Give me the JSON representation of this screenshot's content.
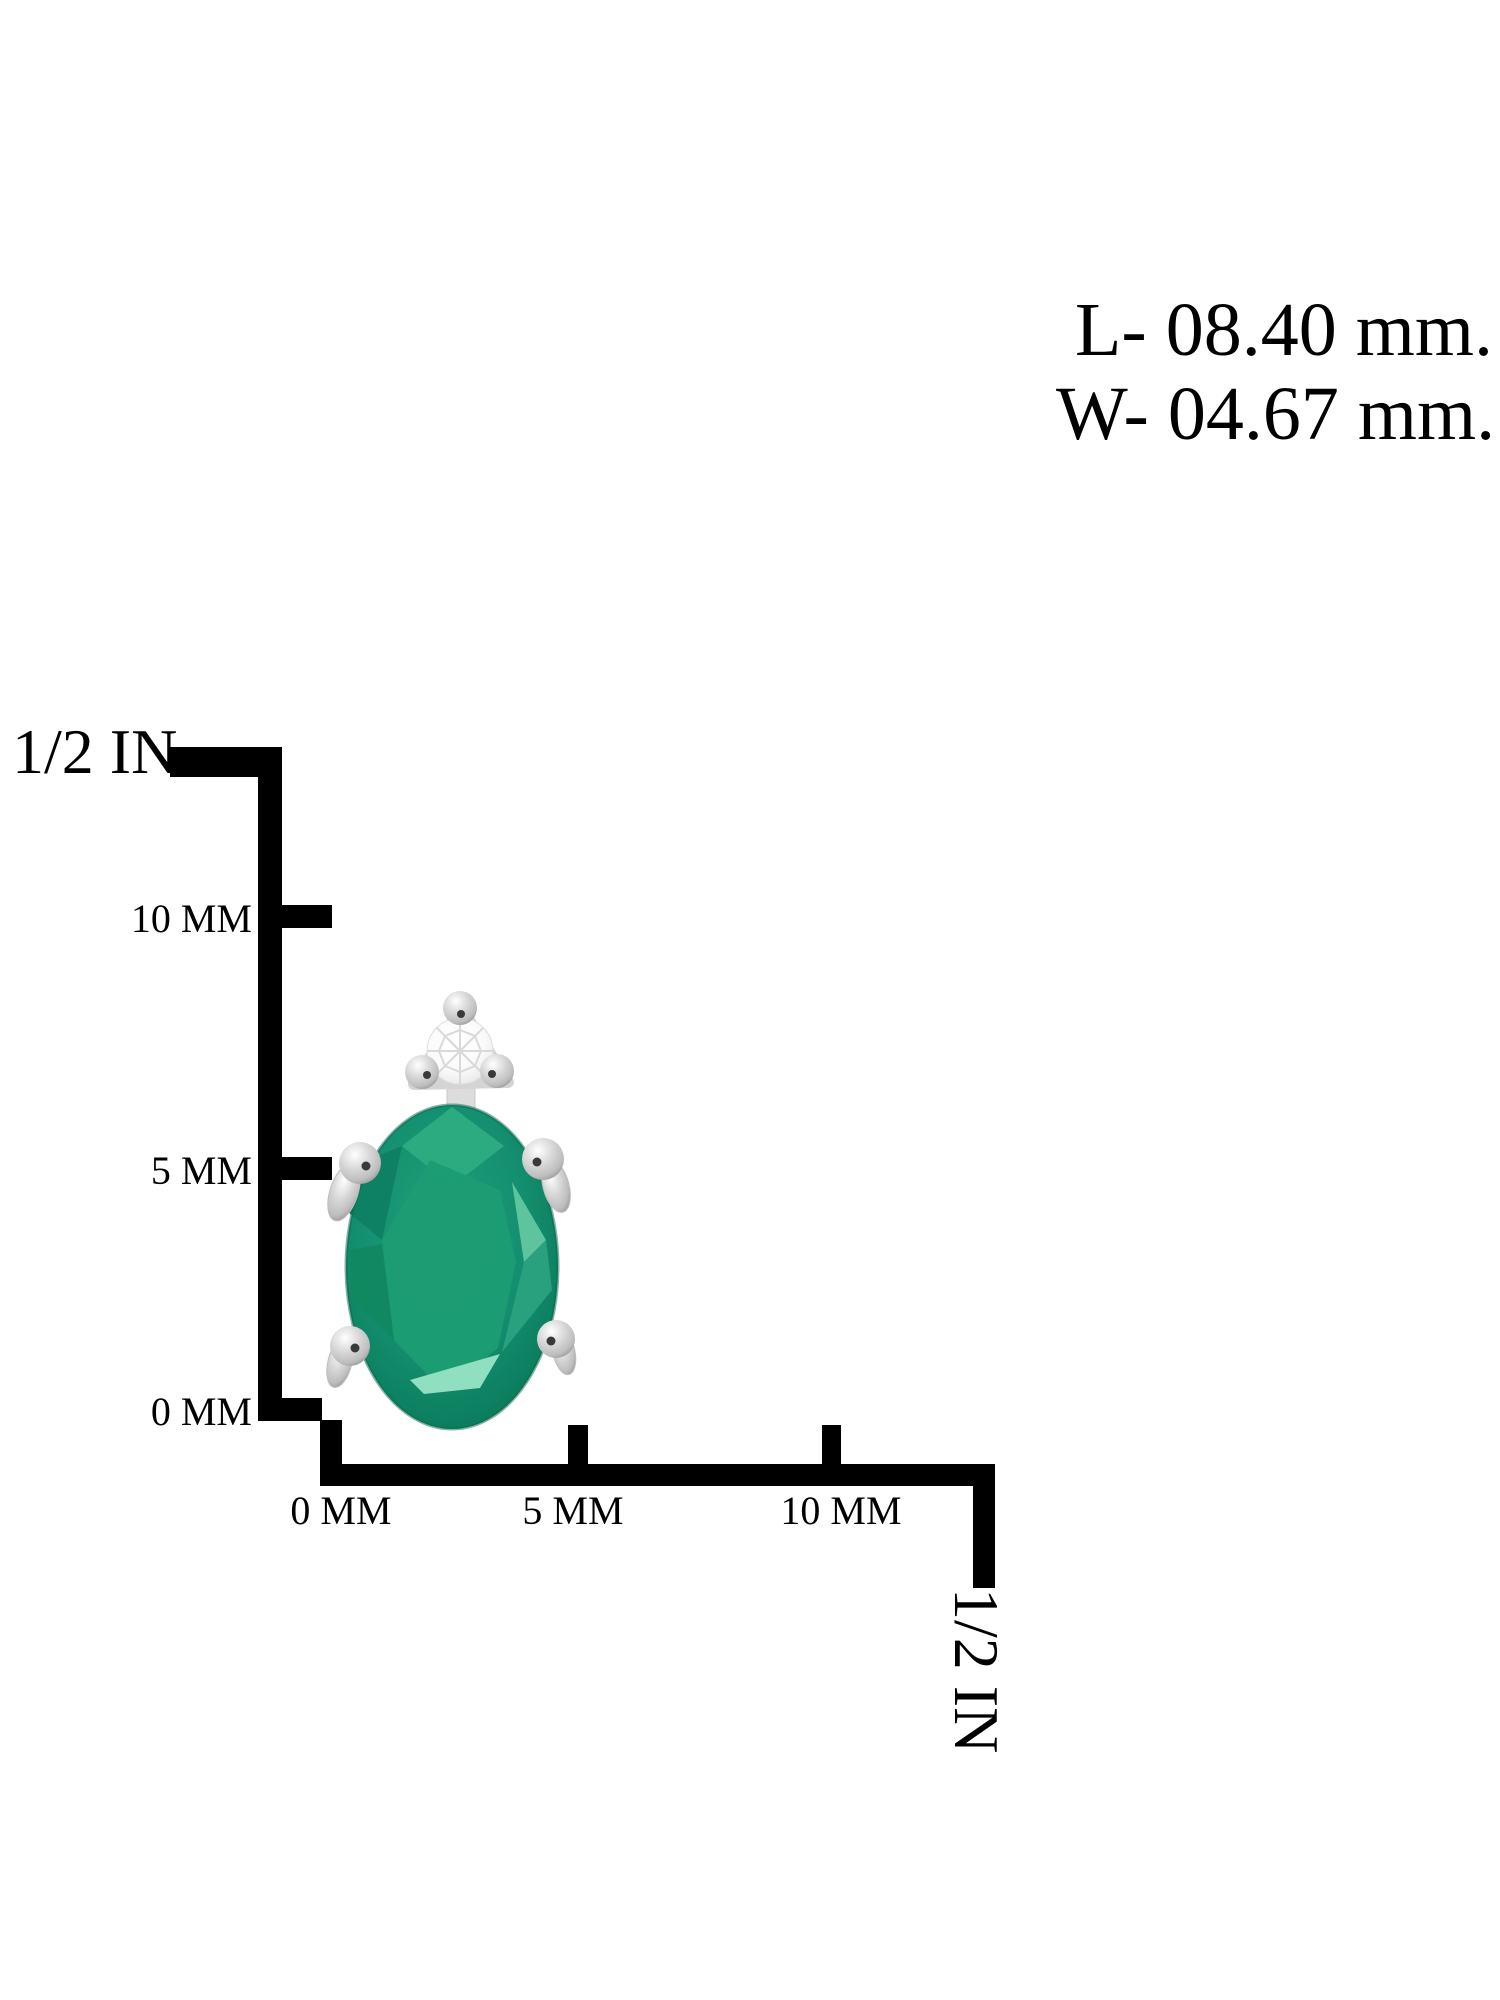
{
  "measurements": {
    "length": "L- 08.40 mm.",
    "width": "W- 04.67 mm."
  },
  "vertical_ruler": {
    "inch_label": "1/2 IN",
    "ticks": [
      "10 MM",
      "5 MM",
      "0 MM"
    ]
  },
  "horizontal_ruler": {
    "ticks": [
      "0 MM",
      "5 MM",
      "10 MM"
    ],
    "inch_label": "1/2 IN"
  },
  "earring": {
    "gemstone": "oval-emerald",
    "accent_stone": "round-diamond",
    "setting": "silver-prongs"
  },
  "colors": {
    "background": "#ffffff",
    "ruler_black": "#000000",
    "emerald_bright": "#2cab81",
    "emerald_table": "#1d9c74",
    "emerald_dark": "#0d8162",
    "emerald_deep": "#0a7058",
    "emerald_light": "#5ec49e",
    "emerald_mint": "#8fdfc0",
    "silver_light": "#ffffff",
    "silver_mid": "#d7d7d7",
    "silver_dark": "#8d8d8d",
    "silver_plate": "#e8e8e8",
    "diamond_white": "#fafafa",
    "diamond_line": "#d9d9d9",
    "prong_speck": "#3a3a3a"
  }
}
